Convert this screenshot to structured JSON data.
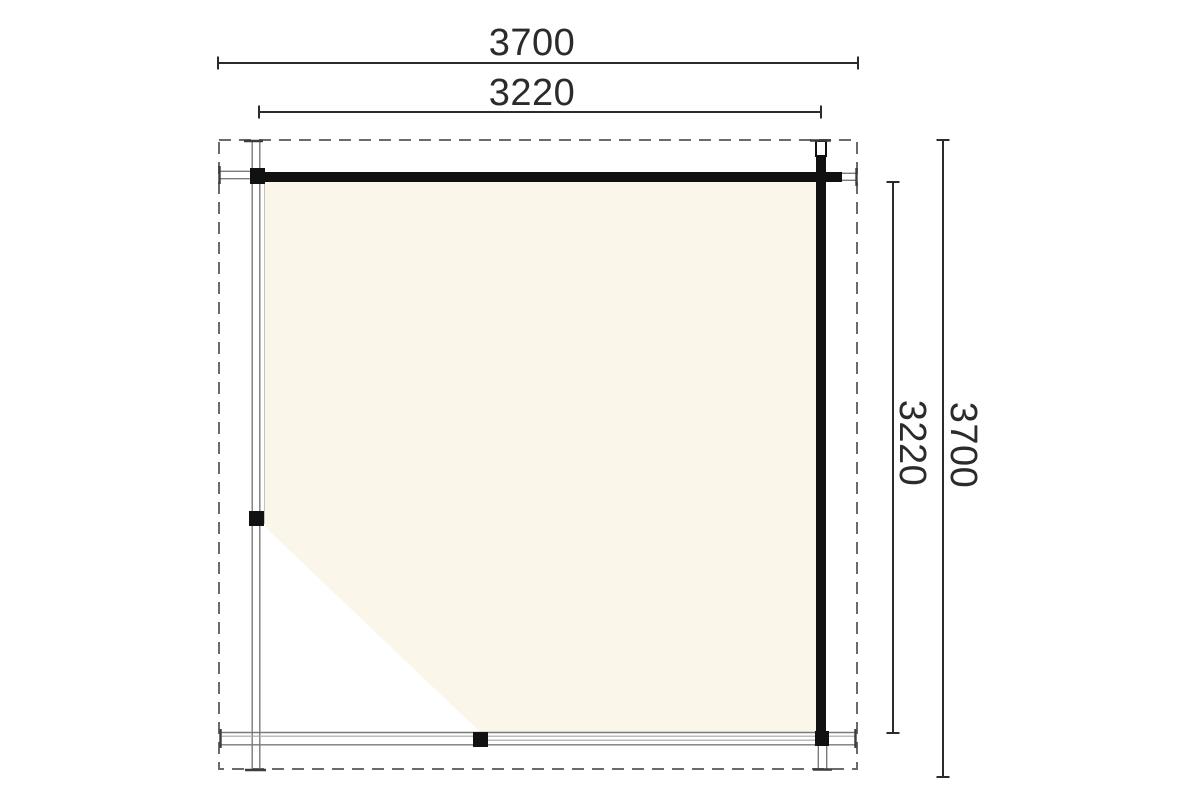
{
  "drawing": {
    "type": "floor-plan",
    "dimensions": {
      "top_outer": "3700",
      "top_inner": "3220",
      "right_inner": "3220",
      "right_outer": "3700"
    },
    "colors": {
      "wall": "#111111",
      "floor": "#fbf6ea",
      "floor-edge": "#c9c5b5",
      "dim": "#2b2b2b",
      "beam": "#7a7a7a",
      "beam-light": "#a6a6a6",
      "cap": "#3c3c3c",
      "dash": "#6b6b6b"
    }
  }
}
